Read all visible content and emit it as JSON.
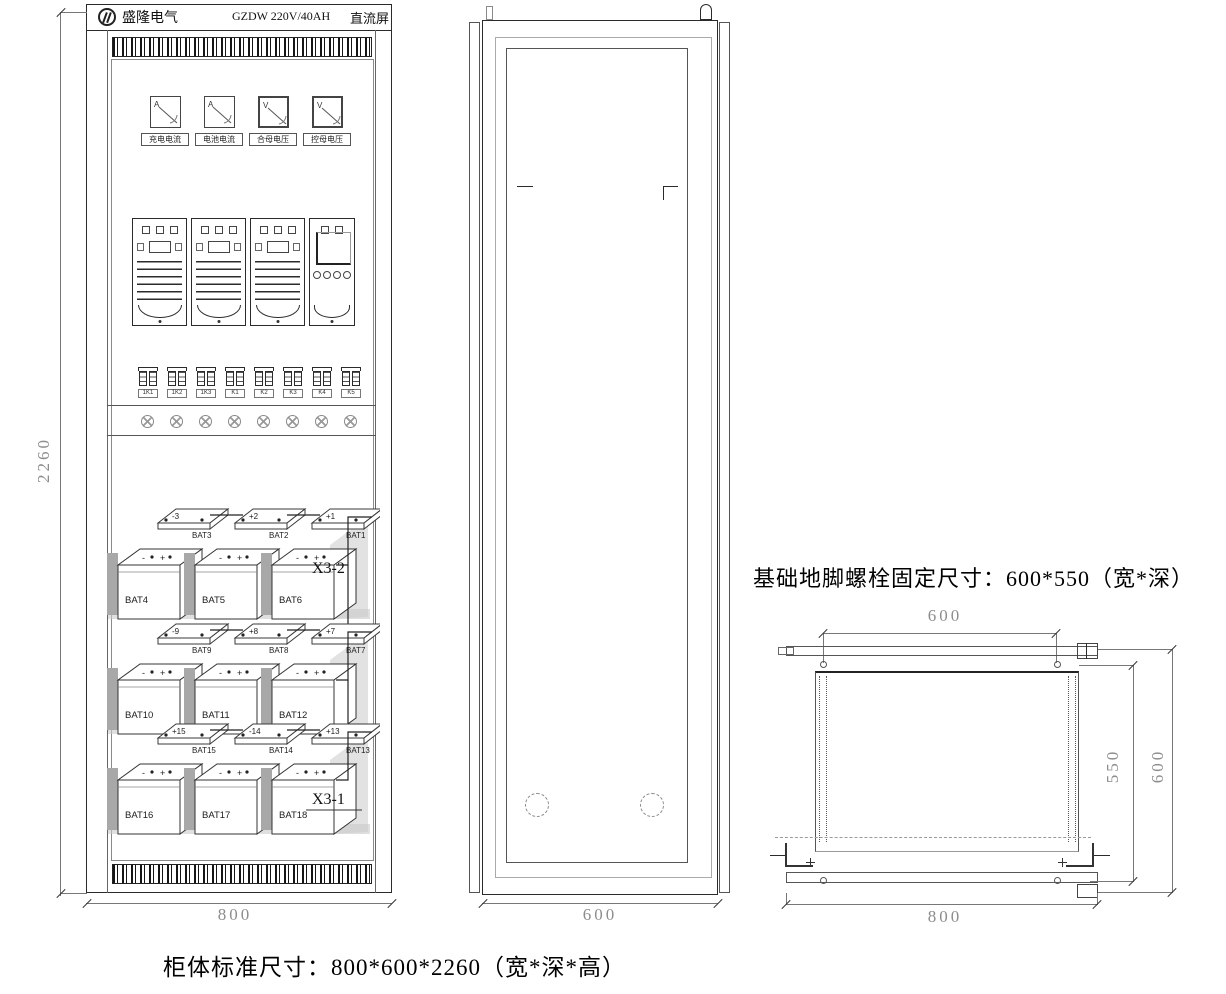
{
  "header": {
    "brand": "盛隆电气",
    "model": "GZDW 220V/40AH",
    "product": "直流屏"
  },
  "front_view": {
    "meters": [
      {
        "symbol": "A",
        "label": "充电电流"
      },
      {
        "symbol": "A",
        "label": "电池电流"
      },
      {
        "symbol": "V",
        "label": "合母电压"
      },
      {
        "symbol": "V",
        "label": "控母电压"
      }
    ],
    "breaker_labels": [
      "1K1",
      "1K2",
      "1K3",
      "K1",
      "K2",
      "K3",
      "K4",
      "K5"
    ],
    "lamp_count": 8,
    "battery_polarity": [
      "-",
      "+"
    ],
    "battery_rows": [
      {
        "back_labels": [
          "BAT3",
          "BAT2",
          "BAT1"
        ],
        "front_labels": [
          "BAT4",
          "BAT5",
          "BAT6"
        ],
        "terminals": [
          "-3",
          "+2",
          "+1"
        ],
        "connector": "X3-2"
      },
      {
        "back_labels": [
          "BAT9",
          "BAT8",
          "BAT7"
        ],
        "front_labels": [
          "BAT10",
          "BAT11",
          "BAT12"
        ],
        "terminals": [
          "-9",
          "+8",
          "+7"
        ],
        "connector": ""
      },
      {
        "back_labels": [
          "BAT15",
          "BAT14",
          "BAT13"
        ],
        "front_labels": [
          "BAT16",
          "BAT17",
          "BAT18"
        ],
        "terminals": [
          "+15",
          "-14",
          "+13"
        ],
        "connector": "X3-1"
      }
    ],
    "dim_height": "2260",
    "dim_width": "800"
  },
  "side_view": {
    "dim_depth": "600"
  },
  "plan_view": {
    "caption": "基础地脚螺栓固定尺寸：600*550（宽*深）",
    "dim_bolt_span": "600",
    "dim_bolt_depth": "550",
    "dim_depth": "600",
    "dim_width": "800"
  },
  "footer": {
    "caption": "柜体标准尺寸：800*600*2260（宽*深*高）"
  }
}
